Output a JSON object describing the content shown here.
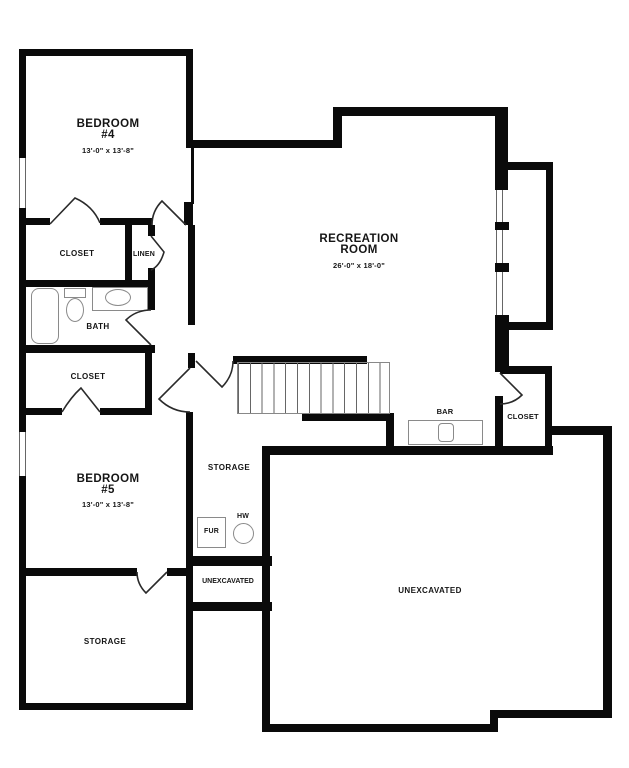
{
  "plan": {
    "title": "Basement Floor Plan",
    "colors": {
      "wall": "#0a0a0a",
      "background": "#ffffff"
    },
    "rooms": {
      "bedroom4": {
        "name_line1": "BEDROOM",
        "name_line2": "#4",
        "dims": "13'-0\" x 13'-8\""
      },
      "recreation": {
        "name_line1": "RECREATION",
        "name_line2": "ROOM",
        "dims": "26'-0\" x 18'-0\""
      },
      "bedroom5": {
        "name_line1": "BEDROOM",
        "name_line2": "#5",
        "dims": "13'-0\" x 13'-8\""
      },
      "closet_bedroom4": {
        "name": "CLOSET"
      },
      "linen": {
        "name": "LINEN"
      },
      "bath": {
        "name": "BATH"
      },
      "closet_bedroom5": {
        "name": "CLOSET"
      },
      "storage_hall": {
        "name": "STORAGE"
      },
      "furnace": {
        "name": "FUR"
      },
      "water_heater": {
        "name": "HW"
      },
      "unexcavated_small": {
        "name": "UNEXCAVATED"
      },
      "storage_lower": {
        "name": "STORAGE"
      },
      "bar": {
        "name": "BAR"
      },
      "closet_rec": {
        "name": "CLOSET"
      },
      "unexcavated_large": {
        "name": "UNEXCAVATED"
      }
    }
  }
}
